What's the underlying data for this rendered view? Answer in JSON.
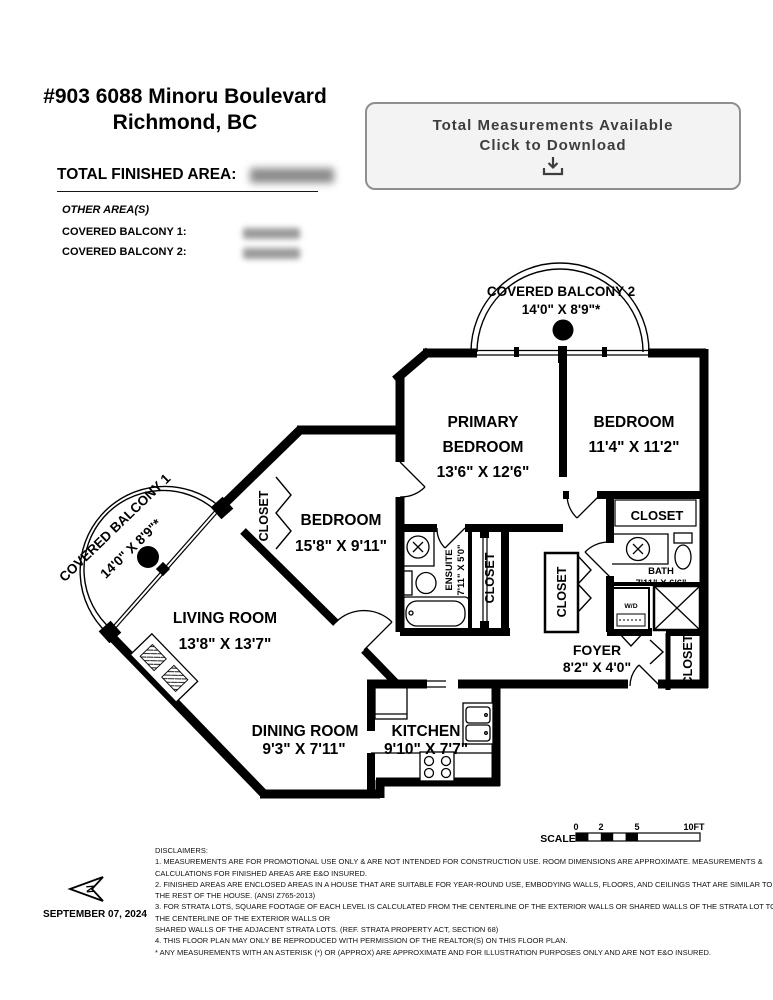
{
  "header": {
    "address_line1": "#903 6088 Minoru Boulevard",
    "address_line2": "Richmond, BC",
    "total_finished_area_label": "TOTAL FINISHED AREA:",
    "other_areas_label": "OTHER AREA(S)",
    "covered_balcony_1_label": "COVERED BALCONY 1:",
    "covered_balcony_2_label": "COVERED BALCONY 2:"
  },
  "download_box": {
    "line1": "Total Measurements Available",
    "line2": "Click to Download"
  },
  "plan": {
    "covered_balcony_2": {
      "name": "COVERED BALCONY 2",
      "dims": "14'0\" X 8'9\"*"
    },
    "covered_balcony_1": {
      "name": "COVERED BALCONY 1",
      "dims": "14'0\" X 8'9\"*"
    },
    "primary_bedroom": {
      "name1": "PRIMARY",
      "name2": "BEDROOM",
      "dims": "13'6\" X 12'6\""
    },
    "bedroom_right": {
      "name": "BEDROOM",
      "dims": "11'4\" X 11'2\""
    },
    "bedroom_left": {
      "name": "BEDROOM",
      "dims": "15'8\" X 9'11\""
    },
    "living_room": {
      "name": "LIVING ROOM",
      "dims": "13'8\" X 13'7\""
    },
    "dining_room": {
      "name": "DINING ROOM",
      "dims": "9'3\" X 7'11\""
    },
    "kitchen": {
      "name": "KITCHEN",
      "dims": "9'10\" X 7'7\""
    },
    "foyer": {
      "name": "FOYER",
      "dims": "8'2\" X 4'0\""
    },
    "bath": {
      "name": "BATH",
      "dims": "7'11\" X 6'6\""
    },
    "ensuite": {
      "name": "ENSUITE",
      "dims": "7'11\" X 5'0\""
    },
    "closet_label": "CLOSET",
    "wd_label": "W/D"
  },
  "scale_bar": {
    "label": "SCALE",
    "ticks": [
      "0",
      "2",
      "5",
      "10FT"
    ]
  },
  "compass": {
    "n_label": "N"
  },
  "footer": {
    "date": "SEPTEMBER 07, 2024",
    "disclaimers": [
      "DISCLAIMERS:",
      "1. MEASUREMENTS ARE FOR PROMOTIONAL USE ONLY & ARE NOT INTENDED FOR CONSTRUCTION USE. ROOM DIMENSIONS ARE APPROXIMATE. MEASUREMENTS &",
      "CALCULATIONS FOR FINISHED AREAS ARE E&O INSURED.",
      "2. FINISHED AREAS ARE ENCLOSED AREAS IN A HOUSE THAT ARE SUITABLE FOR YEAR-ROUND USE, EMBODYING WALLS, FLOORS, AND CEILINGS THAT ARE SIMILAR TO",
      "THE REST OF THE HOUSE. (ANSI Z765-2013)",
      "3. FOR STRATA LOTS, SQUARE FOOTAGE OF EACH LEVEL IS CALCULATED FROM THE CENTERLINE OF THE EXTERIOR WALLS OR SHARED WALLS OF THE STRATA LOT TO",
      "THE CENTERLINE OF THE EXTERIOR WALLS OR",
      "SHARED WALLS OF THE ADJACENT STRATA LOTS. (REF. STRATA PROPERTY ACT, SECTION 68)",
      "4. THIS FLOOR PLAN MAY ONLY BE REPRODUCED WITH PERMISSION OF THE REALTOR(S) ON THIS FLOOR PLAN.",
      "* ANY MEASUREMENTS WITH AN ASTERISK (*) OR (APPROX) ARE APPROXIMATE AND FOR ILLUSTRATION PURPOSES ONLY AND ARE NOT E&O INSURED."
    ]
  }
}
